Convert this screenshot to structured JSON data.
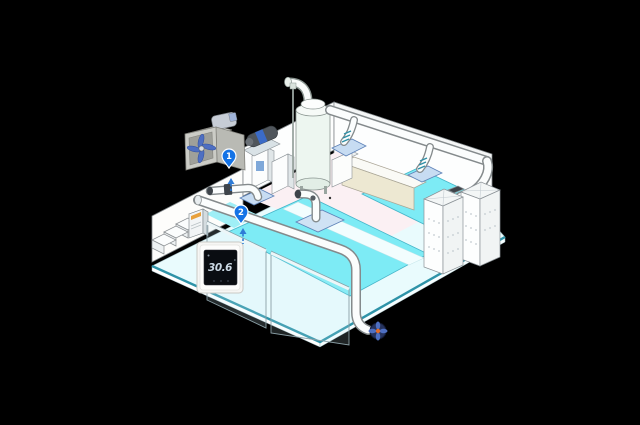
{
  "thermostat": {
    "value": "30.6",
    "unit": "°"
  },
  "markers": [
    {
      "id": "marker-1",
      "label": "1"
    },
    {
      "id": "marker-2",
      "label": "2"
    }
  ],
  "icons": [
    "inline-duct-fan-icon",
    "water-treatment-tank-icon",
    "circulation-pump-icon",
    "ceiling-diffuser-icon",
    "air-handling-unit-icon",
    "wall-controller-icon",
    "thermostat-icon",
    "outlet-fan-icon",
    "stairs-icon",
    "map-pin-icon"
  ],
  "colors": {
    "background": "#000000",
    "water": "#7DEBF5",
    "water_light": "#9FEFF6",
    "deck": "#E9FBFD",
    "edge_teal": "#2E93A8",
    "interior_pink": "#FBF0F3",
    "wall_beige": "#EDE8D2",
    "wall_white": "#FDFEFE",
    "duct_fill": "#FBFDFD",
    "duct_outline": "#848A8C",
    "plate_blue": "#C7DCF2",
    "flex_teal": "#2F8FA6",
    "marker_blue": "#1473E6",
    "arrow_blue": "#2E7BD6",
    "fan_blade_blue": "#4E6FC2",
    "outlet_fan_navy": "#26335E",
    "outlet_fan_hub_orange": "#E06A28",
    "thermostat_frame": "#F6F6F4",
    "thermostat_screen": "#0A0D12",
    "thermostat_text": "#CBD8E4"
  }
}
